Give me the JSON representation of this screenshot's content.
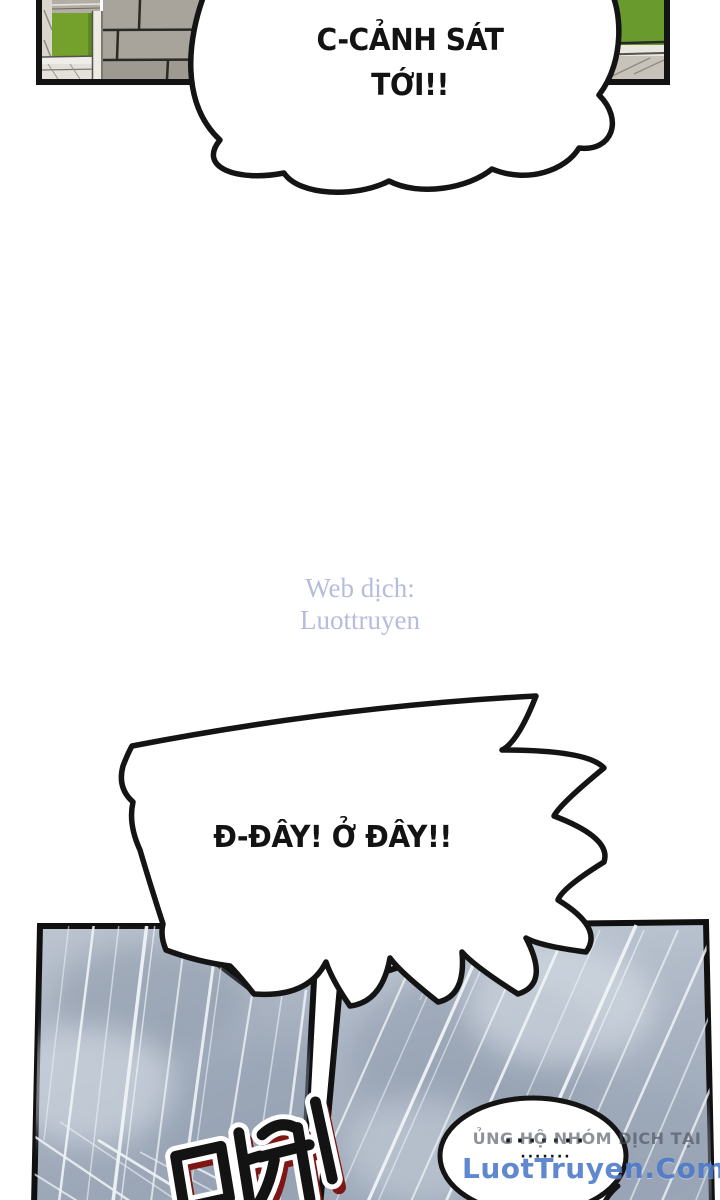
{
  "comic": {
    "bubble1": {
      "line1": "C-CẢNH SÁT",
      "line2": "TỚI!!"
    },
    "bubble2": {
      "line1": "Đ-ĐÂY! Ở ĐÂY!!"
    },
    "bubble3": {
      "dots_row1": "·······",
      "dots_row2": "·······"
    },
    "center_watermark": {
      "line1": "Web dịch:",
      "line2": "Luottruyen"
    },
    "bottom_watermark": {
      "line1": "ỦNG HỘ NHÓM DỊCH TẠI",
      "line2": "LuotTruyen.Com"
    },
    "sfx": {
      "text": "멈춰!"
    },
    "colors": {
      "ink": "#131313",
      "grass_green": "#73a12b",
      "wall_green": "#699a2e",
      "brick_gray": "#a8a49c",
      "sidewalk_gray": "#c7c3bb",
      "rain_panel_base": "#a6b0bf",
      "watermark_center": "#b7bcdc",
      "watermark_gray": "#6b7078",
      "watermark_blue": "#4070c4",
      "sfx_shadow_red": "#7e1713"
    }
  }
}
